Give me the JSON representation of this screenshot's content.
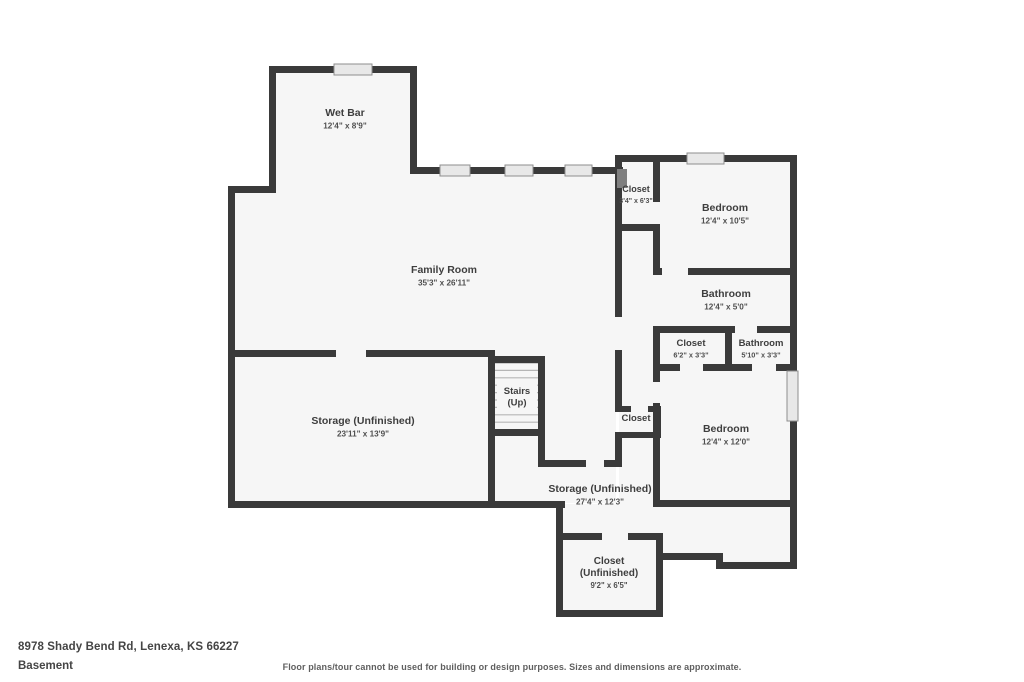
{
  "footer": {
    "address": "8978 Shady Bend Rd, Lenexa, KS 66227",
    "level": "Basement",
    "disclaimer": "Floor plans/tour cannot be used for building or design purposes. Sizes and dimensions are approximate."
  },
  "floorplan": {
    "colors": {
      "wall": "#3a3a3a",
      "floor": "#f6f6f6",
      "window_fill": "#e8e8e8",
      "window_stroke": "#8e8e8e",
      "tread": "#b5b5b5",
      "room_name": "#3e3e3e",
      "room_dims": "#4f4f4f",
      "door_hatch": "#7f7f7f"
    },
    "rooms": [
      {
        "name": "Wet Bar",
        "dims": "12'4\" x 8'9\"",
        "cx": 345,
        "cy": 116,
        "size": 10.5
      },
      {
        "name": "Family Room",
        "dims": "35'3\" x 26'11\"",
        "cx": 444,
        "cy": 273,
        "size": 10.5
      },
      {
        "name": "Closet",
        "dims": "3'4\" x 6'3\"",
        "cx": 636,
        "cy": 192,
        "size": 9
      },
      {
        "name": "Bedroom",
        "dims": "12'4\" x 10'5\"",
        "cx": 725,
        "cy": 211,
        "size": 10.5
      },
      {
        "name": "Bathroom",
        "dims": "12'4\" x 5'0\"",
        "cx": 726,
        "cy": 297,
        "size": 10.5
      },
      {
        "name": "Closet",
        "dims": "6'2\" x 3'3\"",
        "cx": 691,
        "cy": 346,
        "size": 9.5
      },
      {
        "name": "Bathroom",
        "dims": "5'10\" x 3'3\"",
        "cx": 761,
        "cy": 346,
        "size": 9.5
      },
      {
        "name": "Stairs\n(Up)",
        "dims": "",
        "cx": 517,
        "cy": 394,
        "size": 9.5
      },
      {
        "name": "Closet",
        "dims": "",
        "cx": 636,
        "cy": 421,
        "size": 9.5
      },
      {
        "name": "Bedroom",
        "dims": "12'4\" x 12'0\"",
        "cx": 726,
        "cy": 432,
        "size": 10.5
      },
      {
        "name": "Storage (Unfinished)",
        "dims": "23'11\" x 13'9\"",
        "cx": 363,
        "cy": 424,
        "size": 10.5
      },
      {
        "name": "Storage (Unfinished)",
        "dims": "27'4\" x 12'3\"",
        "cx": 600,
        "cy": 492,
        "size": 10.5
      },
      {
        "name": "Closet\n(Unfinished)",
        "dims": "9'2\" x 6'5\"",
        "cx": 609,
        "cy": 564,
        "size": 10
      }
    ],
    "floors": [
      [
        272,
        69,
        142,
        122
      ],
      [
        231,
        189,
        388,
        168
      ],
      [
        413,
        170,
        206,
        22
      ],
      [
        619,
        158,
        172,
        347
      ],
      [
        231,
        353,
        260,
        150
      ],
      [
        491,
        353,
        125,
        150
      ],
      [
        560,
        504,
        233,
        51
      ],
      [
        720,
        504,
        71,
        60
      ],
      [
        560,
        536,
        97,
        76
      ]
    ],
    "walls": [
      [
        269,
        66,
        148,
        7
      ],
      [
        269,
        66,
        7,
        127
      ],
      [
        410,
        66,
        7,
        105
      ],
      [
        410,
        167,
        213,
        7
      ],
      [
        228,
        186,
        48,
        7
      ],
      [
        228,
        186,
        7,
        171
      ],
      [
        228,
        350,
        108,
        7
      ],
      [
        366,
        350,
        129,
        7
      ],
      [
        228,
        350,
        7,
        158
      ],
      [
        228,
        501,
        337,
        7
      ],
      [
        488,
        350,
        7,
        158
      ],
      [
        488,
        356,
        57,
        7
      ],
      [
        538,
        356,
        7,
        111
      ],
      [
        488,
        429,
        55,
        7
      ],
      [
        538,
        460,
        48,
        7
      ],
      [
        604,
        460,
        18,
        7
      ],
      [
        615,
        155,
        7,
        162
      ],
      [
        615,
        350,
        7,
        60
      ],
      [
        615,
        433,
        7,
        34
      ],
      [
        615,
        155,
        182,
        7
      ],
      [
        790,
        155,
        7,
        414
      ],
      [
        653,
        155,
        7,
        47
      ],
      [
        653,
        224,
        7,
        51
      ],
      [
        653,
        326,
        7,
        56
      ],
      [
        653,
        403,
        7,
        104
      ],
      [
        615,
        224,
        45,
        7
      ],
      [
        653,
        268,
        9,
        7
      ],
      [
        688,
        268,
        109,
        7
      ],
      [
        653,
        326,
        82,
        7
      ],
      [
        757,
        326,
        40,
        7
      ],
      [
        653,
        364,
        27,
        7
      ],
      [
        703,
        364,
        49,
        7
      ],
      [
        776,
        364,
        21,
        7
      ],
      [
        725,
        326,
        7,
        45
      ],
      [
        615,
        406,
        16,
        6
      ],
      [
        648,
        406,
        12,
        6
      ],
      [
        615,
        432,
        46,
        6
      ],
      [
        654,
        406,
        7,
        32
      ],
      [
        653,
        500,
        144,
        7
      ],
      [
        660,
        553,
        63,
        7
      ],
      [
        716,
        553,
        7,
        16
      ],
      [
        716,
        562,
        77,
        7
      ],
      [
        556,
        501,
        7,
        116
      ],
      [
        556,
        533,
        46,
        7
      ],
      [
        628,
        533,
        35,
        7
      ],
      [
        656,
        533,
        7,
        84
      ],
      [
        556,
        610,
        107,
        7
      ]
    ],
    "windows": [
      [
        334,
        64,
        38,
        11
      ],
      [
        440,
        165,
        30,
        11
      ],
      [
        505,
        165,
        28,
        11
      ],
      [
        565,
        165,
        27,
        11
      ],
      [
        687,
        153,
        37,
        11
      ],
      [
        787,
        371,
        11,
        50
      ]
    ],
    "stairs": {
      "x": 495,
      "y": 363,
      "w": 43,
      "count": 10,
      "gap": 7.4,
      "label_bg": [
        497,
        384,
        40,
        26
      ]
    },
    "door_hatch": [
      617,
      169,
      10,
      19
    ]
  }
}
